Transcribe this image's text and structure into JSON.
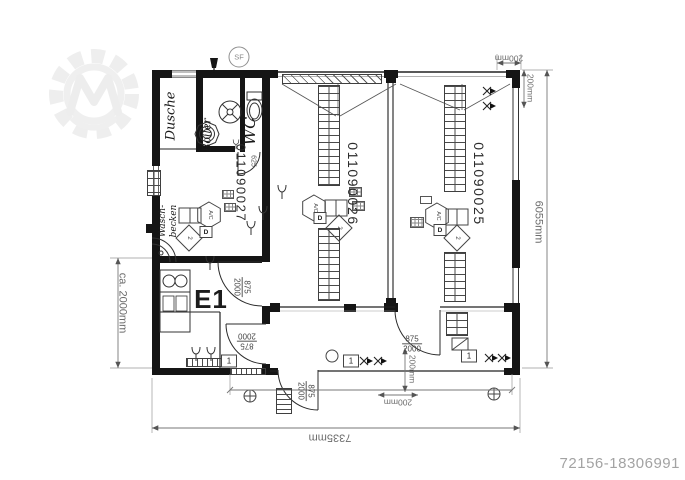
{
  "branding": {
    "watermark_icon": "gear-m-logo",
    "photo_id": "72156-18306991"
  },
  "rooms": {
    "dusche": "Dusche",
    "boiler": "Boiler",
    "wc": "WC",
    "washroom_line1": "Wasch-",
    "washroom_line2": "becken",
    "washroom_no": "011090027",
    "kitchen_unit": "E1",
    "storage_left_no": "011090026",
    "storage_right_no": "011090025"
  },
  "dimensions": {
    "total_width": "7335mm",
    "total_depth": "6055mm",
    "annex_depth": "ca. 2000mm",
    "offset_top": "200mm",
    "offset_top_v": "200mm",
    "offset_bottom_v": "200mm",
    "offset_bottom_h": "200mm",
    "wc_door": "625"
  },
  "doors": [
    {
      "w": "875",
      "h": "2000"
    },
    {
      "w": "875",
      "h": "2000"
    },
    {
      "w": "875",
      "h": "2000"
    },
    {
      "w": "875",
      "h": "2000"
    }
  ],
  "symbols": {
    "site_ref": "SF",
    "switch": "1",
    "ac_unit": "A/C",
    "diamond": "2",
    "device": "D"
  }
}
